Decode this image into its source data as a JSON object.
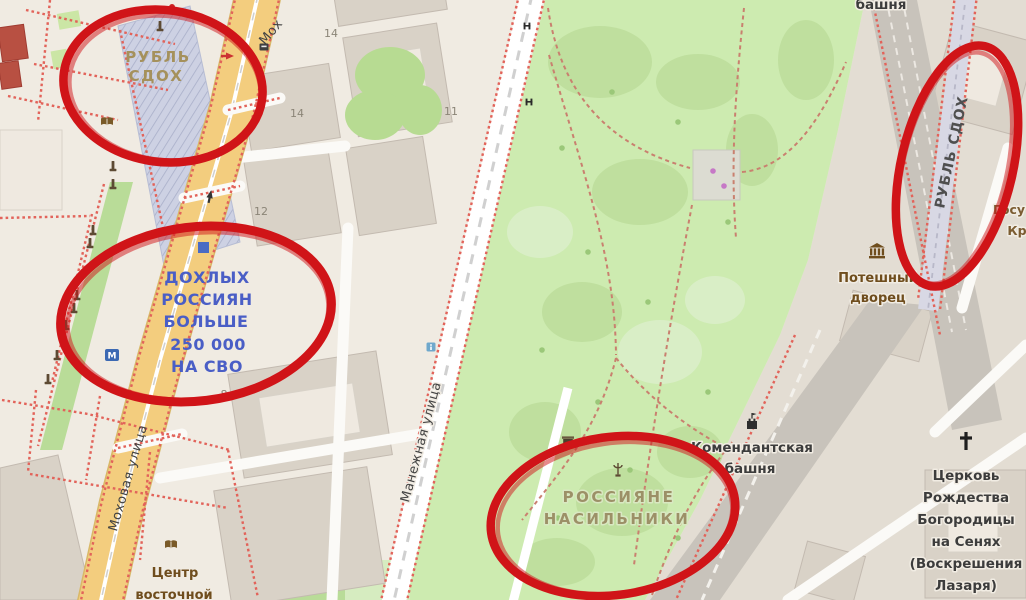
{
  "map_style": "openstreetmap",
  "palette": {
    "annotation_red": "#d01418",
    "vandal_tan": "#a5915c",
    "vandal_blue": "#4a5ec6",
    "vandal_olive": "#9c9067",
    "vandal_gray": "#4f4f4f",
    "road_yellow": "#f3cd7e",
    "park_green": "#cdebb0",
    "building_gray": "#d9d2c7",
    "kremlin_beige": "#e3ddd3",
    "band_gray": "#c8c3bb",
    "background": "#f0ebe2"
  },
  "annotations": {
    "shape": "hand-drawn red ellipse",
    "count": 4
  },
  "vandalism": {
    "ruble_top": {
      "lines": [
        "РУБЛЬ",
        "СДОХ"
      ]
    },
    "dead_russians": {
      "lines": [
        "ДОХЛЫХ",
        "РОССИЯН",
        "БОЛЬШЕ",
        "250 000",
        "НА СВО"
      ]
    },
    "rapists": {
      "lines": [
        "РОССИЯНЕ",
        "НАСИЛЬНИКИ"
      ]
    },
    "ruble_right": {
      "text": "РУБЛЬ СДОХ"
    }
  },
  "streets": {
    "mokhovaya": {
      "name": "Моховая улица"
    },
    "mokhovaya_partial": {
      "name": "Мох"
    },
    "manezhnaya": {
      "name": "Манежная улица"
    }
  },
  "places": {
    "poteshny_palace": {
      "lines": [
        "Потешный",
        "дворец"
      ]
    },
    "komendant_tower": {
      "lines": [
        "Комендантская",
        "башня"
      ]
    },
    "church": {
      "lines": [
        "Церковь",
        "Рождества",
        "Богородицы",
        "на Сенях",
        "(Воскрешения",
        "Лазаря)"
      ]
    },
    "east_center": {
      "lines": [
        "Центр",
        "восточной"
      ]
    },
    "tower_top": {
      "text": "башня"
    },
    "partial_gosu": {
      "lines": [
        "Госу",
        "Кр"
      ]
    }
  },
  "house_numbers": {
    "n14a": "14",
    "n14b": "14",
    "n11": "11",
    "n12": "12",
    "n8": "8"
  },
  "transit": {
    "metro_letter": "М"
  }
}
